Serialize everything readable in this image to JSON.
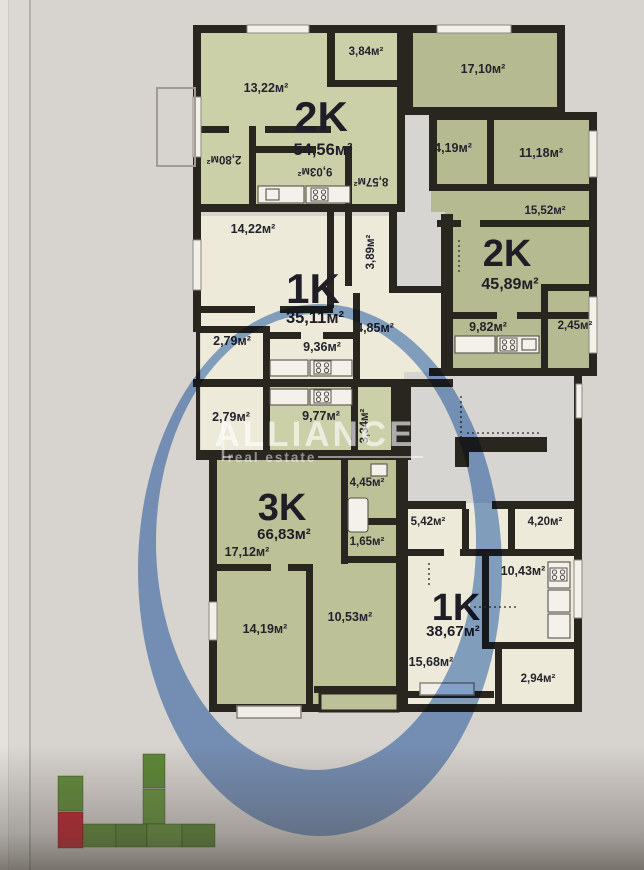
{
  "watermark": {
    "brand": "ALLIANCE",
    "tagline": "real estate"
  },
  "apartments": [
    {
      "type": "2K",
      "area": "54,56м²"
    },
    {
      "type": "2K",
      "area": "45,89м²"
    },
    {
      "type": "1K",
      "area": "35,11м²"
    },
    {
      "type": "3K",
      "area": "66,83м²"
    },
    {
      "type": "1K",
      "area": "38,67м²"
    }
  ],
  "rooms": [
    {
      "label": "13,22м²"
    },
    {
      "label": "3,84м²"
    },
    {
      "label": "17,10м²"
    },
    {
      "label": "2,80м²"
    },
    {
      "label": "9,03м²"
    },
    {
      "label": "8,57м²"
    },
    {
      "label": "4,19м²"
    },
    {
      "label": "11,18м²"
    },
    {
      "label": "15,52м²"
    },
    {
      "label": "14,22м²"
    },
    {
      "label": "3,89м²"
    },
    {
      "label": "4,85м²"
    },
    {
      "label": "2,79м²"
    },
    {
      "label": "9,36м²"
    },
    {
      "label": "9,82м²"
    },
    {
      "label": "2,45м²"
    },
    {
      "label": "2,79м²"
    },
    {
      "label": "9,77м²"
    },
    {
      "label": "3,34м²"
    },
    {
      "label": "4,45м²"
    },
    {
      "label": "1,65м²"
    },
    {
      "label": "17,12м²"
    },
    {
      "label": "14,19м²"
    },
    {
      "label": "10,53м²"
    },
    {
      "label": "5,42м²"
    },
    {
      "label": "4,20м²"
    },
    {
      "label": "10,43м²"
    },
    {
      "label": "15,68м²"
    },
    {
      "label": "2,94м²"
    }
  ],
  "colors": {
    "wall": "#29251f",
    "room_green_light": "#ccd0a8",
    "room_green_dark": "#b5ba90",
    "room_green_3k": "#bcc197",
    "room_cream": "#edead9",
    "corridor": "#d7d5d1",
    "paper": "#d7d3ce",
    "marker_blue": "#7099d4",
    "label_text": "#24232c",
    "logo_green": "#618c3a",
    "logo_red": "#bf2531"
  }
}
